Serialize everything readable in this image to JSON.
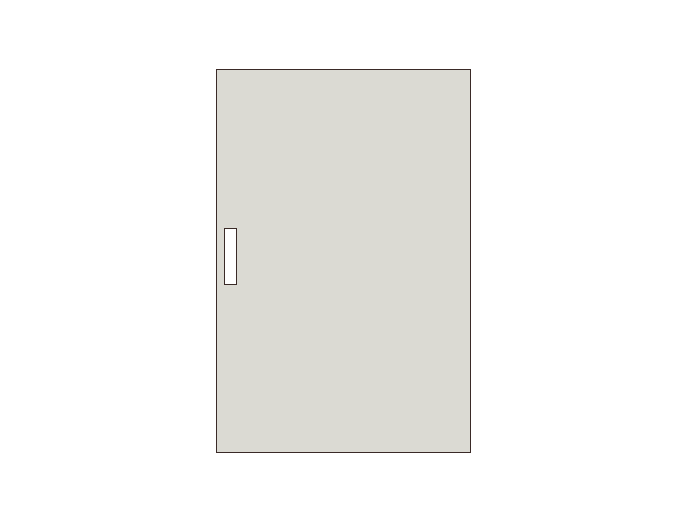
{
  "scene": {
    "background_color": "#ffffff",
    "shapes": {
      "door": {
        "name": "door-panel",
        "fill": "#dbdad3",
        "stroke": "#3a2a27",
        "stroke_width_px": 1.5
      },
      "handle": {
        "name": "door-handle",
        "fill": "#ffffff",
        "stroke": "#3a2a27",
        "stroke_width_px": 1.5
      }
    }
  }
}
